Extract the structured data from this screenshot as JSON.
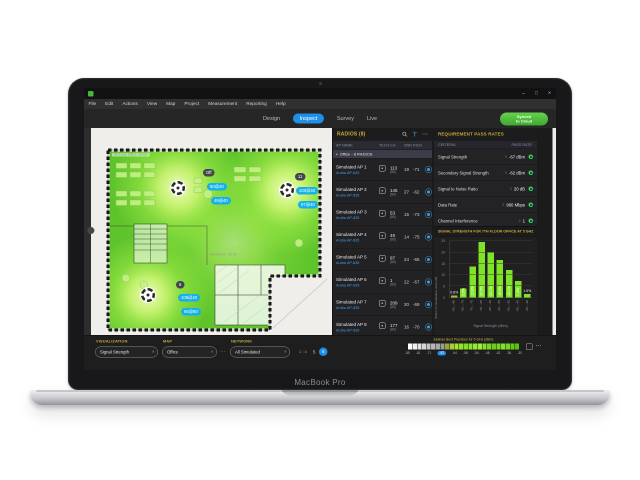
{
  "laptop": {
    "label": "MacBook Pro"
  },
  "window_controls": [
    "–",
    "□",
    "×"
  ],
  "menu_items": [
    "File",
    "Edit",
    "Actions",
    "View",
    "Map",
    "Project",
    "Measurement",
    "Reporting",
    "Help"
  ],
  "toolbar": {
    "tabs": [
      "Design",
      "Inspect",
      "Survey",
      "Live"
    ],
    "active_tab": "Inspect",
    "cloud_button": [
      "Synced",
      "to Cloud"
    ]
  },
  "map": {
    "title": "7th Floor Office 39x6m",
    "room_label": "VANKATO - 61 m²",
    "aps": [
      {
        "tag": "Off",
        "labels": [
          "60@40",
          "49@40"
        ]
      },
      {
        "tag": "11",
        "labels": [
          "100@40",
          "97@40"
        ]
      },
      {
        "tag": "6",
        "labels": [
          "108@40",
          "65@80"
        ]
      }
    ]
  },
  "radios": {
    "title": "RADIOS (8)",
    "columns": [
      "AP NAME",
      "TECH",
      "CH",
      "SNR",
      "RSSI"
    ],
    "group": "Office - 8 RADIOS",
    "rows": [
      {
        "name": "Simulated AP 1",
        "model": "Aruba AP-635",
        "ch": "113",
        "ch_width": "(80)",
        "snr": "19",
        "rssi": "-71"
      },
      {
        "name": "Simulated AP 2",
        "model": "Aruba AP-635",
        "ch": "145",
        "ch_width": "(80)",
        "snr": "27",
        "rssi": "-62"
      },
      {
        "name": "Simulated AP 3",
        "model": "Aruba AP-635",
        "ch": "53",
        "ch_width": "(80)",
        "snr": "15",
        "rssi": "-73"
      },
      {
        "name": "Simulated AP 4",
        "model": "Aruba AP-635",
        "ch": "49",
        "ch_width": "(80)",
        "snr": "14",
        "rssi": "-75"
      },
      {
        "name": "Simulated AP 5",
        "model": "Aruba AP-635",
        "ch": "97",
        "ch_width": "(80)",
        "snr": "24",
        "rssi": "-65"
      },
      {
        "name": "Simulated AP 6",
        "model": "Aruba AP-635",
        "ch": "1",
        "ch_width": "(80)",
        "snr": "22",
        "rssi": "-67"
      },
      {
        "name": "Simulated AP 7",
        "model": "Aruba AP-635",
        "ch": "209",
        "ch_width": "(80)",
        "snr": "20",
        "rssi": "-69"
      },
      {
        "name": "Simulated AP 8",
        "model": "Aruba AP-635",
        "ch": "177",
        "ch_width": "(80)",
        "snr": "16",
        "rssi": "-70"
      }
    ]
  },
  "requirements": {
    "title": "REQUIREMENT PASS RATES",
    "columns": [
      "CRITERIA",
      "PASS RATE"
    ],
    "status_color": "#2fd15f",
    "rows": [
      {
        "label": "Signal Strength",
        "prefix": "≥",
        "value": "-67 dBm"
      },
      {
        "label": "Secondary Signal Strength",
        "prefix": "≥",
        "value": "-62 dBm"
      },
      {
        "label": "Signal to Noise Ratio",
        "prefix": "≥",
        "value": "20 dB"
      },
      {
        "label": "Data Rate",
        "prefix": "≥",
        "value": "960 Mbps"
      },
      {
        "label": "Channel Interference",
        "prefix": "≤",
        "value": "1"
      }
    ]
  },
  "chart_data": {
    "type": "bar",
    "title": "SIGNAL STRENGTH FOR 7TH FLOOR OFFICE AT 5 GHZ",
    "xlabel": "Signal Strength (dBm)",
    "ylabel": "Share of visualization area (%)",
    "ylim": [
      0,
      25
    ],
    "yticks": [
      0,
      5,
      10,
      15,
      20,
      25
    ],
    "grid": true,
    "categories": [
      "-85 to -80",
      "-80 to -75",
      "-75 to -70",
      "-70 to -65",
      "-65 to -60",
      "-60 to -55",
      "-55 to -50",
      "-50 to -45",
      "-45 to -40"
    ],
    "values": [
      0.8,
      3.9,
      13.8,
      24.5,
      20.1,
      16.6,
      12.1,
      7.2,
      1.5
    ],
    "bar_color": "#7fe426",
    "first_bar_color": "#a9b344"
  },
  "bottom": {
    "visualization_label": "VISUALIZATION",
    "visualization_value": "Signal Strength",
    "map_label": "MAP",
    "map_value": "Office",
    "network_label": "NETWORK",
    "network_value": "All Simulated",
    "scale": "1 : 4",
    "pages": [
      "5",
      "6"
    ],
    "active_page": "6",
    "legend": {
      "title": "Ekahau Best Practices for 5 GHz (dBm)",
      "cells": [
        "#ffffff",
        "#f1f1f1",
        "#e3e3e3",
        "#d5d5d5",
        "#c6c6c6",
        "#b7b7b7",
        "#a8a8a8",
        "#9a9a9a",
        "#9aa43e",
        "#aecb33",
        "#a2e52c",
        "#90e426",
        "#7fdf20",
        "#88e52a",
        "#95e933",
        "#a0ec3a",
        "#8ae02a",
        "#78d620",
        "#6bcd19",
        "#77d822",
        "#84e02b",
        "#74d51d",
        "#65c914",
        "#58bf0e"
      ],
      "ticks": [
        "-85",
        "-81",
        "-71",
        "-67",
        "-64",
        "-58",
        "-54",
        "-48",
        "-42",
        "-36",
        "-30"
      ],
      "selected": "-67"
    }
  }
}
